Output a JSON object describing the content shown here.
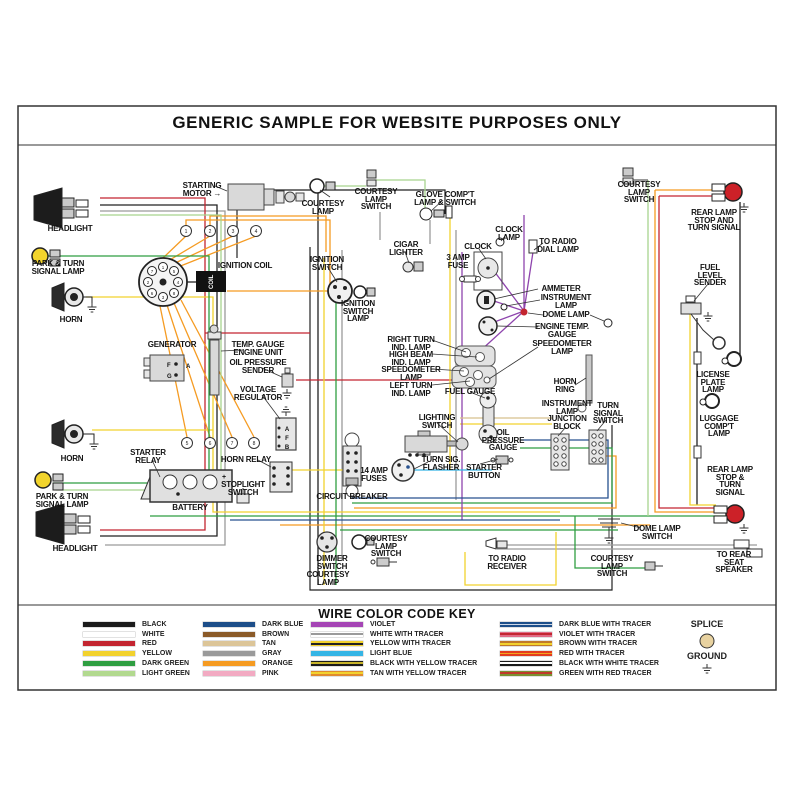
{
  "title": "GENERIC SAMPLE FOR WEBSITE PURPOSES ONLY",
  "key": {
    "title": "WIRE COLOR CODE KEY",
    "splice_label": "SPLICE",
    "ground_label": "GROUND",
    "splice_color": "#e8d2a0",
    "columns": [
      [
        {
          "label": "BLACK",
          "stripes": [
            "#1b1b1b"
          ]
        },
        {
          "label": "WHITE",
          "stripes": [
            "#ffffff"
          ]
        },
        {
          "label": "RED",
          "stripes": [
            "#c32530"
          ]
        },
        {
          "label": "YELLOW",
          "stripes": [
            "#f2d22e"
          ]
        },
        {
          "label": "DARK GREEN",
          "stripes": [
            "#2f9e41"
          ]
        },
        {
          "label": "LIGHT GREEN",
          "stripes": [
            "#b2d98f"
          ]
        }
      ],
      [
        {
          "label": "DARK BLUE",
          "stripes": [
            "#1d4e89"
          ]
        },
        {
          "label": "BROWN",
          "stripes": [
            "#8a5a28"
          ]
        },
        {
          "label": "TAN",
          "stripes": [
            "#dcc598"
          ]
        },
        {
          "label": "GRAY",
          "stripes": [
            "#9a9a9a"
          ]
        },
        {
          "label": "ORANGE",
          "stripes": [
            "#f59b22"
          ]
        },
        {
          "label": "PINK",
          "stripes": [
            "#f2aac2"
          ]
        }
      ],
      [
        {
          "label": "VIOLET",
          "stripes": [
            "#a545b5"
          ]
        },
        {
          "label": "WHITE WITH TRACER",
          "stripes": [
            "#ffffff",
            "#9a9a9a",
            "#ffffff"
          ]
        },
        {
          "label": "YELLOW WITH TRACER",
          "stripes": [
            "#f2d22e",
            "#222222",
            "#f2d22e"
          ]
        },
        {
          "label": "LIGHT BLUE",
          "stripes": [
            "#35b5e5"
          ]
        },
        {
          "label": "BLACK WITH YELLOW TRACER",
          "stripes": [
            "#1b1b1b",
            "#c8b42a",
            "#1b1b1b"
          ]
        },
        {
          "label": "TAN WITH YELLOW TRACER",
          "stripes": [
            "#e08b2d",
            "#f2d22e",
            "#e08b2d"
          ]
        }
      ],
      [
        {
          "label": "DARK BLUE WITH  TRACER",
          "stripes": [
            "#1d4e89",
            "#cfd8e8",
            "#1d4e89"
          ]
        },
        {
          "label": "VIOLET WITH TRACER",
          "stripes": [
            "#e06a85",
            "#c32530",
            "#e06a85"
          ]
        },
        {
          "label": "BROWN WITH TRACER",
          "stripes": [
            "#c07a2a",
            "#f2d22e",
            "#c07a2a"
          ]
        },
        {
          "label": "RED WITH TRACER",
          "stripes": [
            "#e33b1e",
            "#f2a51e",
            "#e33b1e"
          ]
        },
        {
          "label": "BLACK WITH WHITE TRACER",
          "stripes": [
            "#1b1b1b",
            "#ffffff",
            "#1b1b1b"
          ]
        },
        {
          "label": "GREEN WITH RED TRACER",
          "stripes": [
            "#7a9030",
            "#c0392b",
            "#7a9030"
          ]
        }
      ]
    ]
  },
  "diagram": {
    "labels": [
      {
        "id": "headlight-top-label",
        "text": "HEADLIGHT",
        "x": 70,
        "y": 225
      },
      {
        "id": "park-turn-top-label",
        "text": "PARK & TURN\nSIGNAL LAMP",
        "x": 58,
        "y": 260
      },
      {
        "id": "horn-top-label",
        "text": "HORN",
        "x": 71,
        "y": 316
      },
      {
        "id": "horn-bottom-label",
        "text": "HORN",
        "x": 72,
        "y": 455
      },
      {
        "id": "park-turn-bottom-label",
        "text": "PARK & TURN\nSIGNAL LAMP",
        "x": 62,
        "y": 493
      },
      {
        "id": "headlight-bottom-label",
        "text": "HEADLIGHT",
        "x": 75,
        "y": 545
      },
      {
        "id": "starting-motor-label",
        "text": "STARTING\nMOTOR →",
        "x": 202,
        "y": 182
      },
      {
        "id": "ignition-coil-label",
        "text": "IGNITION COIL",
        "x": 245,
        "y": 262
      },
      {
        "id": "generator-label",
        "text": "GENERATOR",
        "x": 172,
        "y": 341
      },
      {
        "id": "temp-gauge-unit-label",
        "text": "TEMP. GAUGE\nENGINE UNIT",
        "x": 258,
        "y": 341
      },
      {
        "id": "oil-sender-label",
        "text": "OIL PRESSURE\nSENDER",
        "x": 258,
        "y": 359
      },
      {
        "id": "voltage-regulator-label",
        "text": "VOLTAGE\nREGULATOR",
        "x": 258,
        "y": 386
      },
      {
        "id": "starter-relay-label",
        "text": "STARTER\nRELAY",
        "x": 148,
        "y": 449
      },
      {
        "id": "horn-relay-label",
        "text": "HORN RELAY",
        "x": 246,
        "y": 456
      },
      {
        "id": "stoplight-switch-label",
        "text": "STOPLIGHT\nSWITCH",
        "x": 243,
        "y": 481
      },
      {
        "id": "battery-label",
        "text": "BATTERY",
        "x": 190,
        "y": 504
      },
      {
        "id": "fuses-label",
        "text": "14 AMP\nFUSES",
        "x": 374,
        "y": 467
      },
      {
        "id": "circuit-breaker-label",
        "text": "CIRCUIT BREAKER",
        "x": 352,
        "y": 493
      },
      {
        "id": "dimmer-switch-label",
        "text": "DIMMER\nSWITCH",
        "x": 332,
        "y": 555
      },
      {
        "id": "courtesy-lamp-bottom-label",
        "text": "COURTESY\nLAMP",
        "x": 328,
        "y": 571
      },
      {
        "id": "courtesy-switch-bottom-center-label",
        "text": "COURTESY\nLAMP\nSWITCH",
        "x": 386,
        "y": 535
      },
      {
        "id": "courtesy-lamp-top-label",
        "text": "COURTESY\nLAMP",
        "x": 323,
        "y": 200
      },
      {
        "id": "courtesy-switch-top-label",
        "text": "COURTESY\nLAMP\nSWITCH",
        "x": 376,
        "y": 188
      },
      {
        "id": "glove-label",
        "text": "GLOVE COMP'T\nLAMP & SWITCH",
        "x": 445,
        "y": 191
      },
      {
        "id": "cigar-label",
        "text": "CIGAR\nLIGHTER",
        "x": 406,
        "y": 241
      },
      {
        "id": "ignition-switch-label",
        "text": "IGNITION\nSWITCH",
        "x": 327,
        "y": 256
      },
      {
        "id": "ignition-switch-lamp-label",
        "text": "IGNITION\nSWITCH\nLAMP",
        "x": 358,
        "y": 300
      },
      {
        "id": "clock-lamp-label",
        "text": "CLOCK\nLAMP",
        "x": 509,
        "y": 226
      },
      {
        "id": "clock-label",
        "text": "CLOCK",
        "x": 478,
        "y": 243
      },
      {
        "id": "amp-fuse-label",
        "text": "3 AMP\nFUSE",
        "x": 458,
        "y": 254
      },
      {
        "id": "radio-dial-label",
        "text": "TO RADIO\nDIAL LAMP",
        "x": 558,
        "y": 238
      },
      {
        "id": "ammeter-label",
        "text": "AMMETER",
        "x": 561,
        "y": 285
      },
      {
        "id": "instrument-lamp-label",
        "text": "INSTRUMENT\nLAMP",
        "x": 566,
        "y": 294
      },
      {
        "id": "dome-lamp-label",
        "text": "DOME LAMP",
        "x": 566,
        "y": 311
      },
      {
        "id": "engine-temp-label",
        "text": "ENGINE TEMP.\nGAUGE",
        "x": 562,
        "y": 323
      },
      {
        "id": "speedometer-lamp-label",
        "text": "SPEEDOMETER\nLAMP",
        "x": 562,
        "y": 340
      },
      {
        "id": "right-turn-label",
        "text": "RIGHT TURN\nIND. LAMP",
        "x": 411,
        "y": 336
      },
      {
        "id": "high-beam-label",
        "text": "HIGH BEAM\nIND. LAMP",
        "x": 411,
        "y": 351
      },
      {
        "id": "speedometer-lamp2-label",
        "text": "SPEEDOMETER\nLAMP",
        "x": 411,
        "y": 366
      },
      {
        "id": "left-turn-label",
        "text": "LEFT TURN\nIND. LAMP",
        "x": 411,
        "y": 382
      },
      {
        "id": "fuel-gauge-label",
        "text": "FUEL GAUGE",
        "x": 470,
        "y": 388
      },
      {
        "id": "lighting-switch-label",
        "text": "LIGHTING\nSWITCH",
        "x": 437,
        "y": 414
      },
      {
        "id": "flasher-label",
        "text": "TURN SIG.\nFLASHER",
        "x": 441,
        "y": 456
      },
      {
        "id": "oil-gauge-label",
        "text": "OIL\nPRESSURE\nGAUGE",
        "x": 503,
        "y": 429
      },
      {
        "id": "starter-button-label",
        "text": "STARTER\nBUTTON",
        "x": 484,
        "y": 464
      },
      {
        "id": "horn-ring-label",
        "text": "HORN\nRING",
        "x": 565,
        "y": 378
      },
      {
        "id": "junction-block-label",
        "text": "INSTRUMENT\nLAMP\nJUNCTION\nBLOCK",
        "x": 567,
        "y": 400
      },
      {
        "id": "turn-signal-switch-label",
        "text": "TURN\nSIGNAL\nSWITCH",
        "x": 608,
        "y": 402
      },
      {
        "id": "courtesy-switch-top-right-label",
        "text": "COURTESY\nLAMP\nSWITCH",
        "x": 639,
        "y": 181
      },
      {
        "id": "rear-lamp-top-label",
        "text": "REAR LAMP\nSTOP AND\nTURN SIGNAL",
        "x": 714,
        "y": 209
      },
      {
        "id": "fuel-sender-label",
        "text": "FUEL\nLEVEL\nSENDER",
        "x": 710,
        "y": 264
      },
      {
        "id": "license-lamp-label",
        "text": "LICENSE\nPLATE\nLAMP",
        "x": 713,
        "y": 371
      },
      {
        "id": "luggage-lamp-label",
        "text": "LUGGAGE\nCOMP'T\nLAMP",
        "x": 719,
        "y": 415
      },
      {
        "id": "rear-lamp-bottom-label",
        "text": "REAR LAMP\nSTOP &\nTURN\nSIGNAL",
        "x": 730,
        "y": 466
      },
      {
        "id": "dome-switch-label",
        "text": "DOME LAMP\nSWITCH",
        "x": 657,
        "y": 525
      },
      {
        "id": "radio-receiver-label",
        "text": "TO RADIO\nRECEIVER",
        "x": 507,
        "y": 555
      },
      {
        "id": "courtesy-switch-bottom-right-label",
        "text": "COURTESY\nLAMP\nSWITCH",
        "x": 612,
        "y": 555
      },
      {
        "id": "rear-speaker-label",
        "text": "TO REAR\nSEAT\nSPEAKER",
        "x": 734,
        "y": 551
      }
    ]
  }
}
